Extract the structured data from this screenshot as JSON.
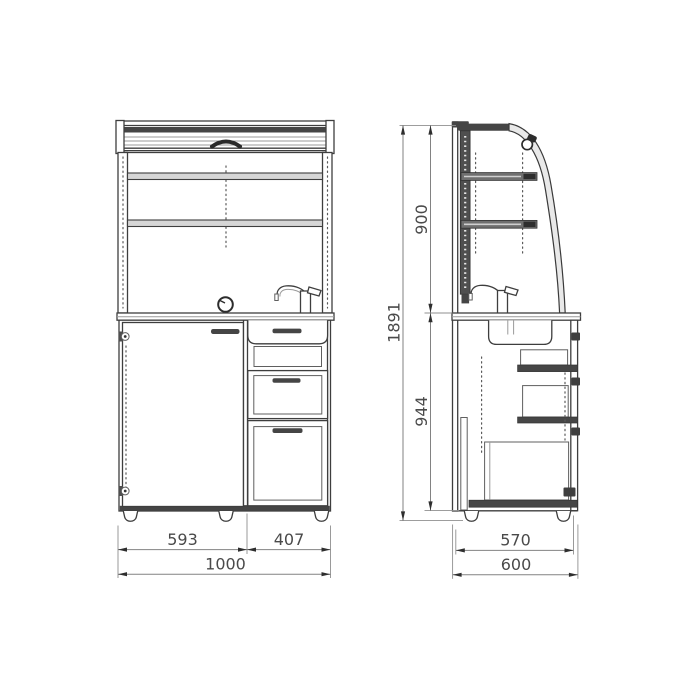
{
  "drawing": {
    "type": "furniture-technical-drawing",
    "background": "#ffffff"
  },
  "colors": {
    "outline": "#3e3e3e",
    "dark_fill": "#454545",
    "shelf_fill": "#d6d6d6",
    "dimension_line": "#828282",
    "label_text": "#4a4a4a"
  },
  "front_view": {
    "dims": {
      "door_width": "593",
      "drawers_width": "407",
      "total_width": "1000"
    }
  },
  "side_view": {
    "dims": {
      "upper_section_height": "900",
      "total_height": "1891",
      "lower_section_height": "944",
      "inner_depth": "570",
      "total_depth": "600"
    }
  }
}
